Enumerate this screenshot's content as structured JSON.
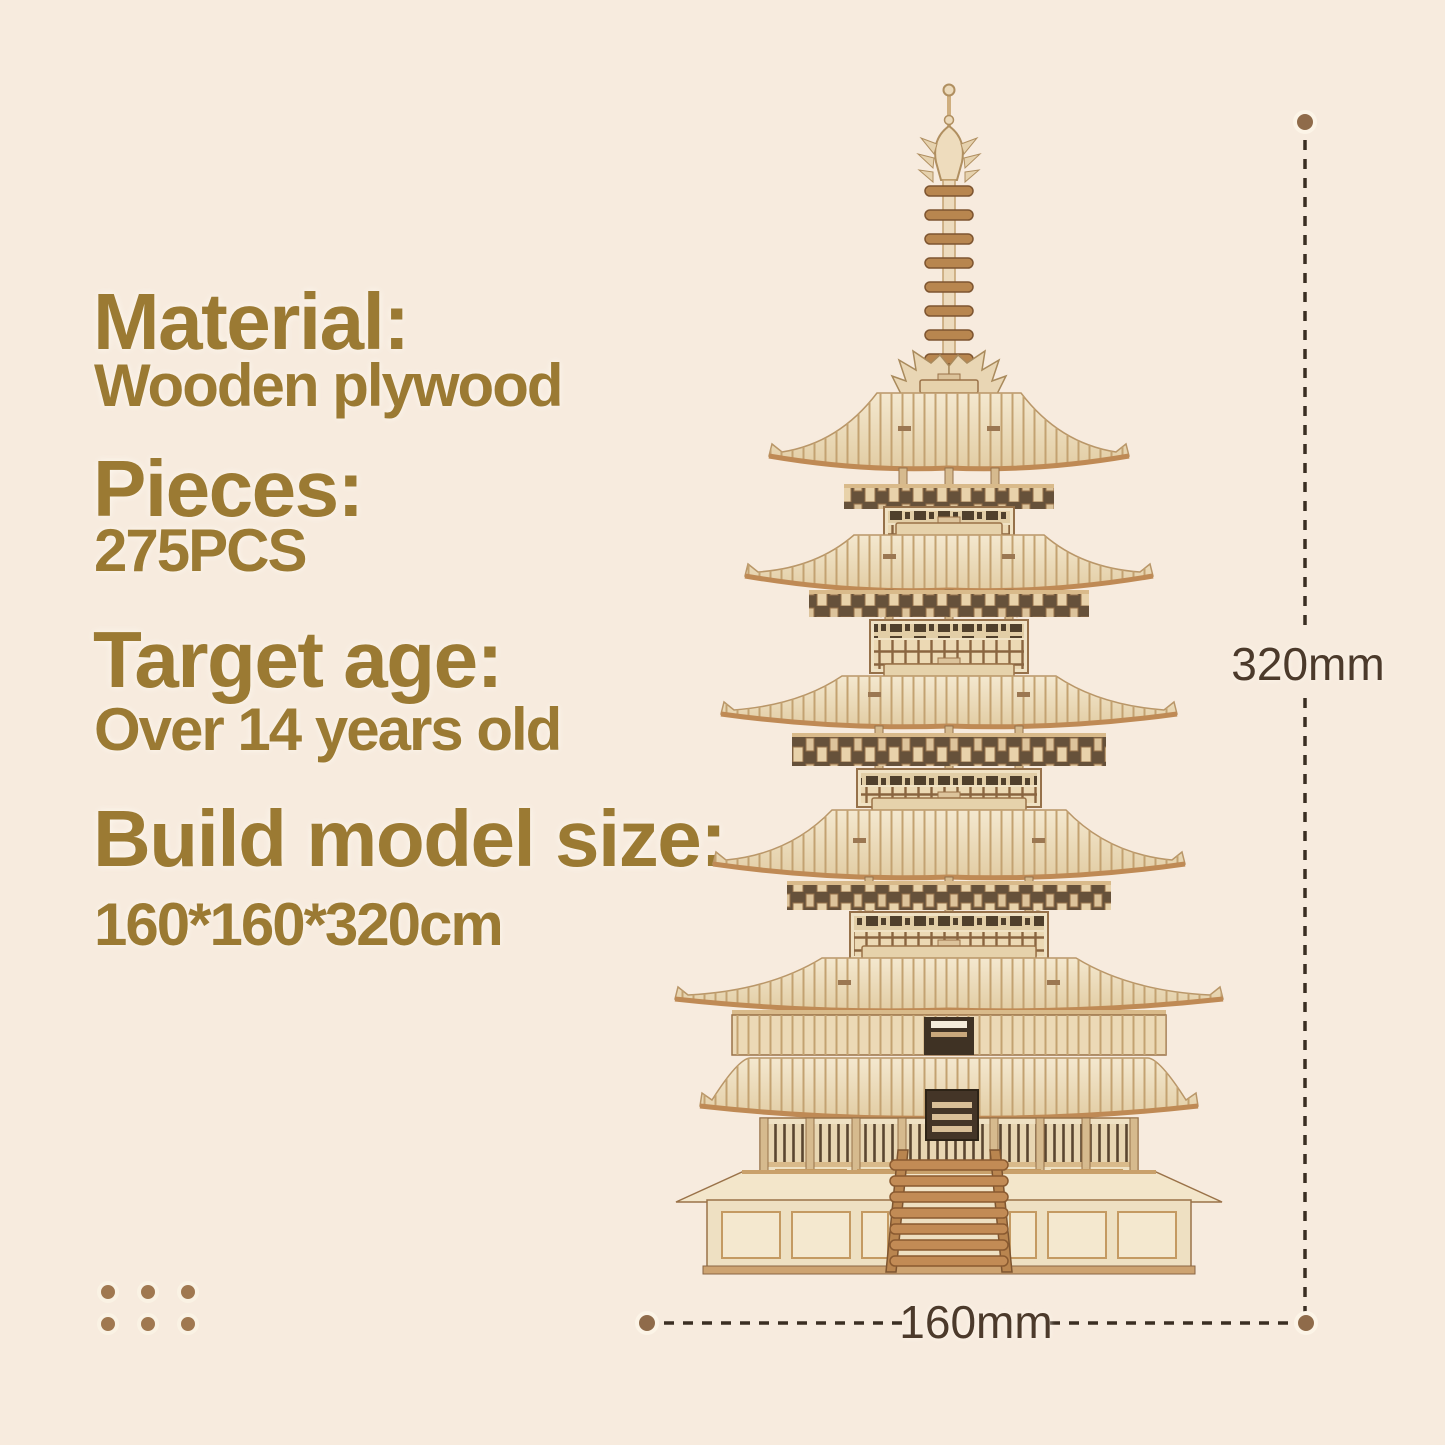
{
  "page": {
    "background_color": "#f7ebde"
  },
  "specs": {
    "text_color": "#9b7a33",
    "items": [
      {
        "label": "Material:",
        "value": "Wooden plywood"
      },
      {
        "label": "Pieces:",
        "value": "275PCS"
      },
      {
        "label": "Target age:",
        "value": "Over 14 years old"
      },
      {
        "label": "Build model size:",
        "value": "160*160*320cm"
      }
    ]
  },
  "dimensions": {
    "height_label": "320mm",
    "width_label": "160mm",
    "text_color": "#4c3a2b",
    "line_color": "#3a2e22",
    "endpoint_dot_color": "#8f6b4a"
  },
  "illustration": {
    "name": "five-tier-wooden-pagoda-model",
    "wood_light": "#f2e5c9",
    "wood_mid": "#e6d2ab",
    "wood_trim": "#c08a58",
    "wood_dark": "#8a5a36"
  },
  "decor": {
    "dot_grid_color": "#a07850",
    "dot_grid_rows": 2,
    "dot_grid_cols": 3
  }
}
